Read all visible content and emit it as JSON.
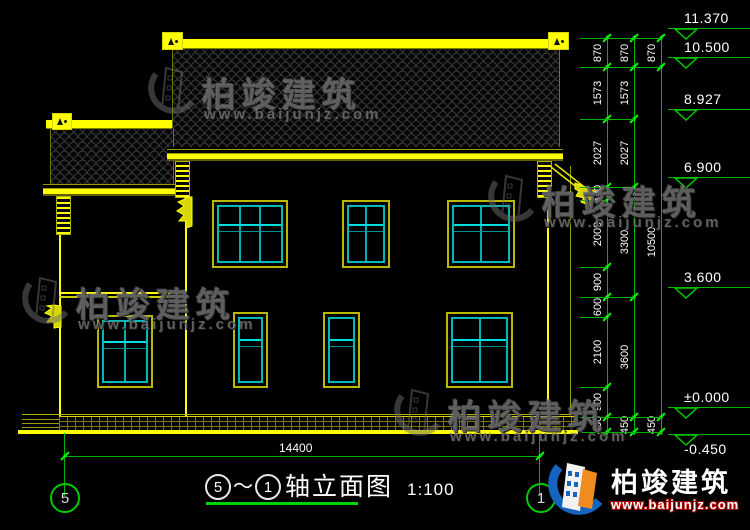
{
  "title_block": {
    "axis_start": "5",
    "separator": "～",
    "axis_end": "1",
    "name": "轴立面图",
    "scale": "1:100"
  },
  "overall_dimension": "14400",
  "axis_bubbles": {
    "start": "5",
    "end": "1"
  },
  "elevation_markers": [
    {
      "label": "11.370",
      "mm": 11370
    },
    {
      "label": "10.500",
      "mm": 10500
    },
    {
      "label": "8.927",
      "mm": 8927
    },
    {
      "label": "6.900",
      "mm": 6900
    },
    {
      "label": "3.600",
      "mm": 3600
    },
    {
      "label": "±0.000",
      "mm": 0
    },
    {
      "label": "-0.450",
      "mm": -450,
      "label_below": true
    }
  ],
  "dimension_columns": [
    {
      "x": 607,
      "segments": [
        870,
        1573,
        2027,
        400,
        2000,
        900,
        600,
        2100,
        900,
        450
      ]
    },
    {
      "x": 634,
      "segments": [
        870,
        1573,
        2027,
        3300,
        3600,
        450
      ]
    },
    {
      "x": 661,
      "segments": [
        870,
        10500,
        450
      ]
    }
  ],
  "windows": [
    {
      "x": 212,
      "y": 200,
      "w": 76,
      "h": 68,
      "cols": 3
    },
    {
      "x": 342,
      "y": 200,
      "w": 48,
      "h": 68,
      "cols": 2
    },
    {
      "x": 447,
      "y": 200,
      "w": 68,
      "h": 68,
      "cols": 2
    },
    {
      "x": 97,
      "y": 315,
      "w": 56,
      "h": 73,
      "cols": 2
    },
    {
      "x": 233,
      "y": 312,
      "w": 35,
      "h": 76,
      "cols": 1
    },
    {
      "x": 323,
      "y": 312,
      "w": 37,
      "h": 76,
      "cols": 1
    },
    {
      "x": 446,
      "y": 312,
      "w": 67,
      "h": 76,
      "cols": 2
    }
  ],
  "watermark": {
    "brand": "柏竣建筑",
    "url": "www.baijunjz.com",
    "positions": [
      {
        "x": 146,
        "y": 62
      },
      {
        "x": 20,
        "y": 272
      },
      {
        "x": 486,
        "y": 170
      },
      {
        "x": 392,
        "y": 384
      }
    ]
  },
  "logo": {
    "brand": "柏竣建筑",
    "url": "www.baijunjz.com"
  },
  "colors": {
    "line_yellow": "#ffff00",
    "line_olive": "#9b9b00",
    "sash_cyan": "#00b8b8",
    "dim_green": "#00b400",
    "tick_green": "#00ff00",
    "text_white": "#ffffff"
  }
}
